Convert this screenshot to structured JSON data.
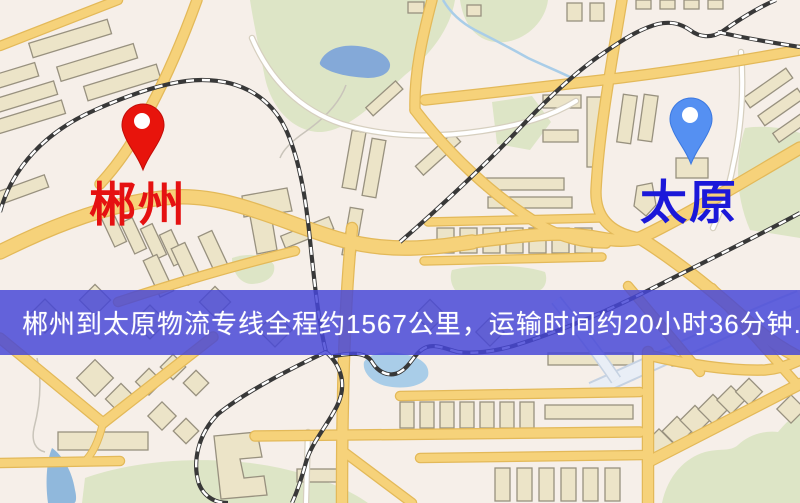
{
  "map": {
    "origin": {
      "label": "郴州",
      "pin_color": "#e8140c",
      "label_color": "#e51111"
    },
    "destination": {
      "label": "太原",
      "pin_color": "#5590f2",
      "label_color": "#1b18d9"
    }
  },
  "banner": {
    "text": "郴州到太原物流专线全程约1567公里，运输时间约20小时36分钟.",
    "background_color": "rgba(70,70,214,0.84)",
    "text_color": "#ffffff",
    "origin": "郴州",
    "destination": "太原",
    "distance_km": "1567",
    "duration": "20小时36分钟"
  },
  "palette": {
    "map_background": "#f6efe9",
    "road_yellow": "#f6d27a",
    "road_casing": "#e3b959",
    "road_white": "#ffffff",
    "pale_blue_road": "#e9eef6",
    "park_green": "#dde5c6",
    "water_blue": "#84a9d8",
    "building_fill": "#ece4c8",
    "building_stroke": "#98917f",
    "railway_dark": "#383838"
  }
}
